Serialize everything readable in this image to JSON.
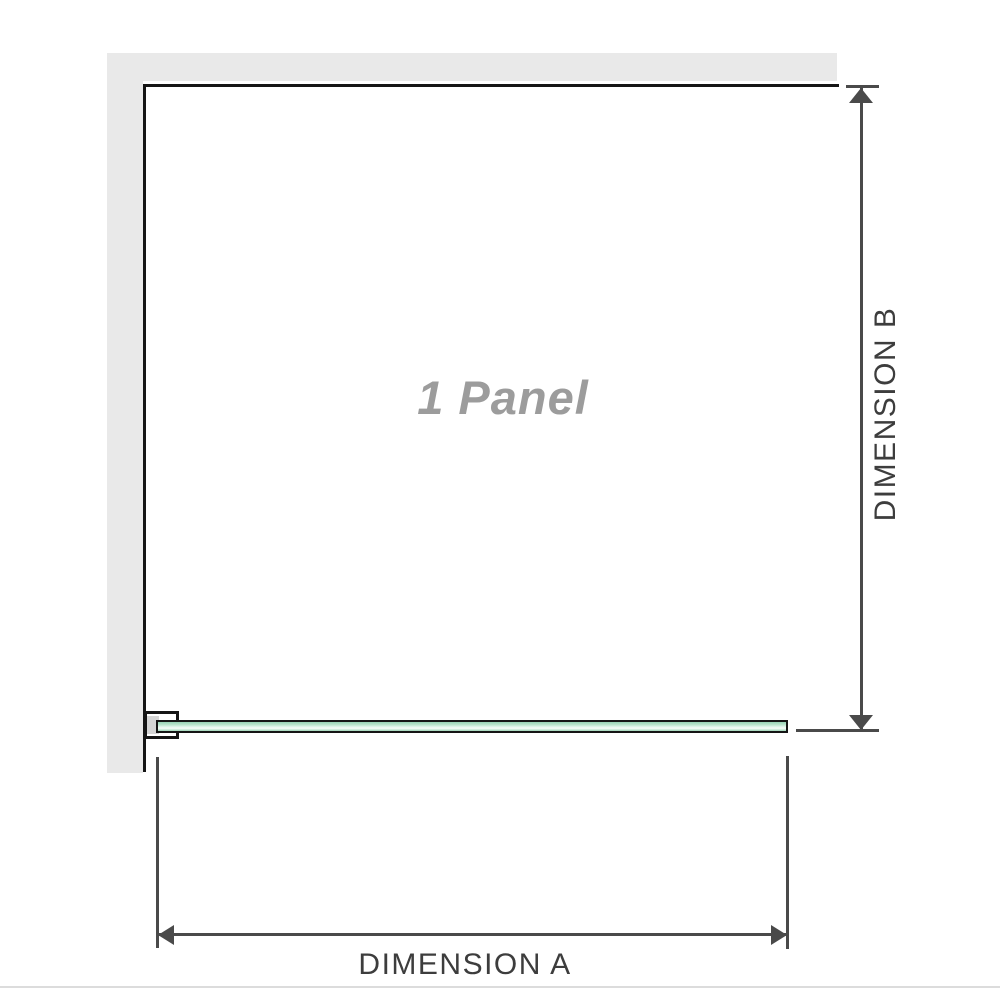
{
  "diagram": {
    "panel_label": "1 Panel",
    "dimension_a": {
      "label": "DIMENSION A"
    },
    "dimension_b": {
      "label": "DIMENSION B"
    }
  },
  "icons": {
    "dimension_b_top": "arrow-up-icon",
    "dimension_b_bottom": "arrow-down-icon",
    "dimension_a_left": "arrow-left-icon",
    "dimension_a_right": "arrow-right-icon"
  },
  "colors": {
    "wall": "#e9e9e9",
    "outline": "#151515",
    "glass_green": "#9cd4b7",
    "glass_highlight": "#e4f5ec",
    "bracket_fill": "#d5d5d5",
    "dimension_line": "#4a4a4a",
    "dimension_label_text": "#3d3d3d",
    "panel_label_text": "#9c9c9c",
    "hairline": "#dcdcdc"
  }
}
